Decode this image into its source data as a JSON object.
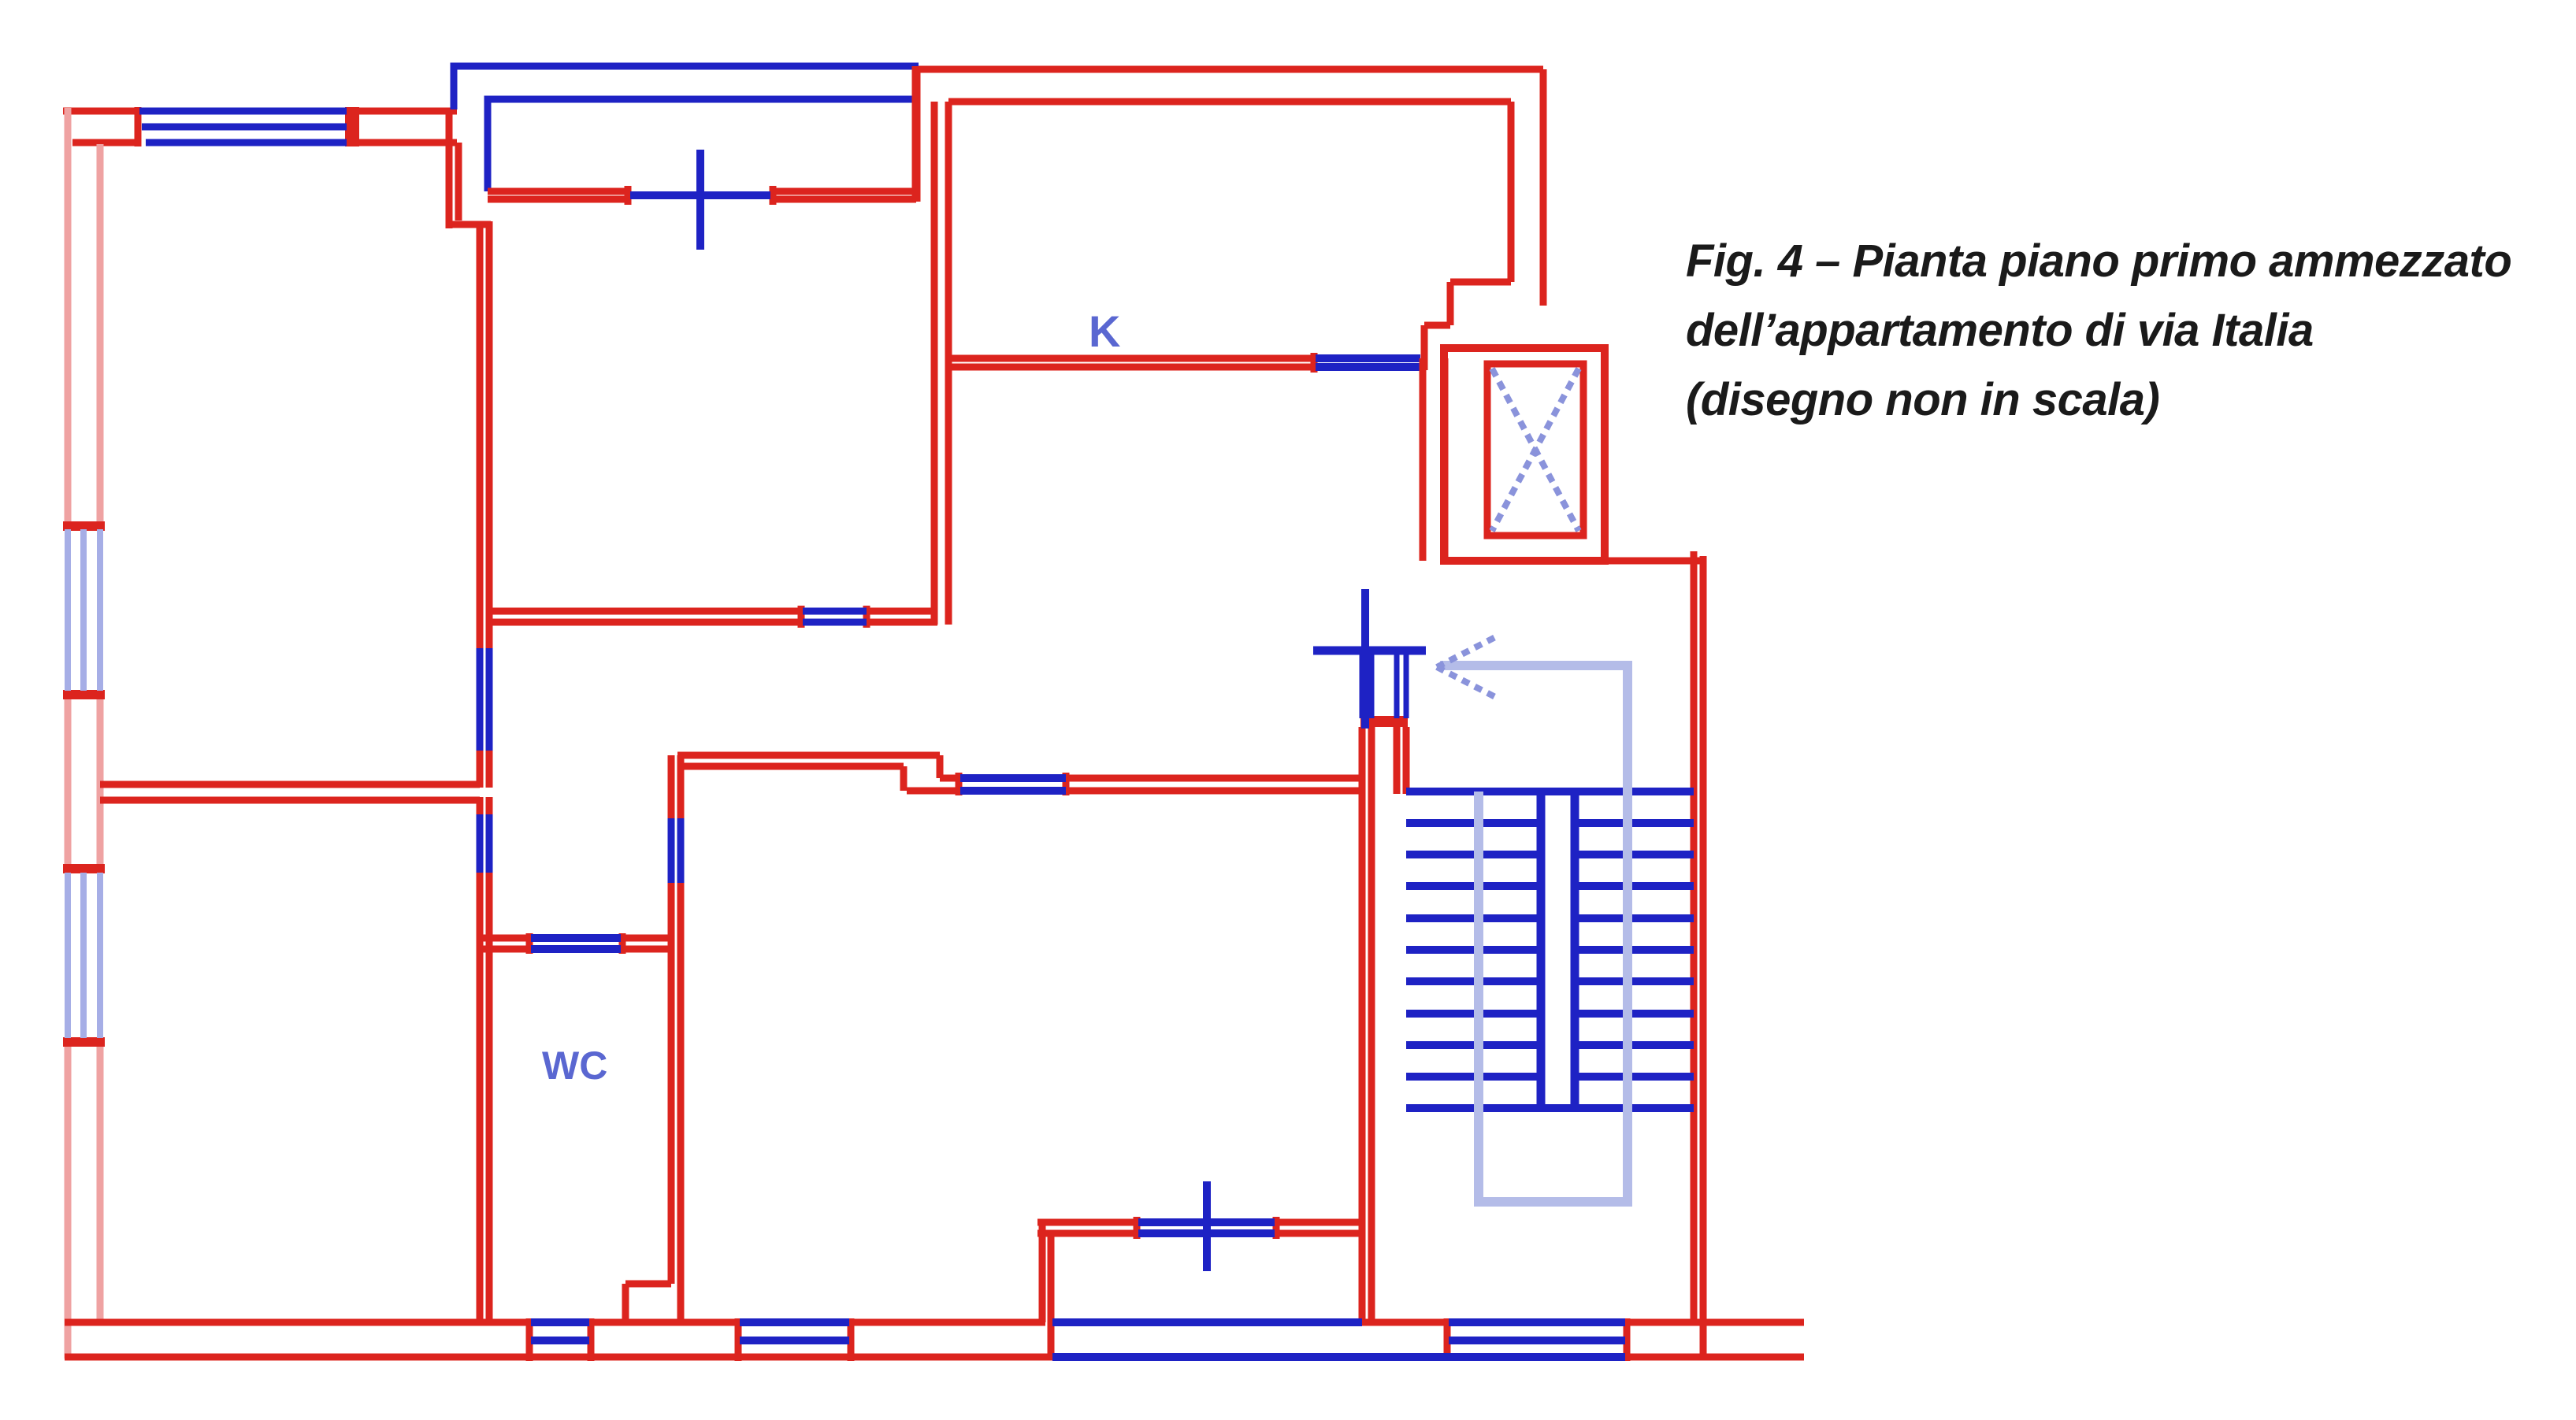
{
  "figure": {
    "type": "floor-plan",
    "labels": {
      "kitchen": "K",
      "wc": "WC"
    },
    "caption": {
      "line1": "Fig. 4 – Pianta piano primo ammezzato",
      "line2": "dell’appartamento di via Italia",
      "line3": "(disegno non in scala)"
    }
  },
  "colors": {
    "wall_red": "#dc241e",
    "wall_pink": "#efa2a2",
    "fixture_blue": "#1e22c4",
    "pale_blue": "#a6aee6",
    "walkline_blue": "#b4bce8",
    "dash_blue": "#8a93db",
    "label_blue": "#5a67d1",
    "caption_text": "#1a1a1a",
    "background": "#ffffff"
  }
}
